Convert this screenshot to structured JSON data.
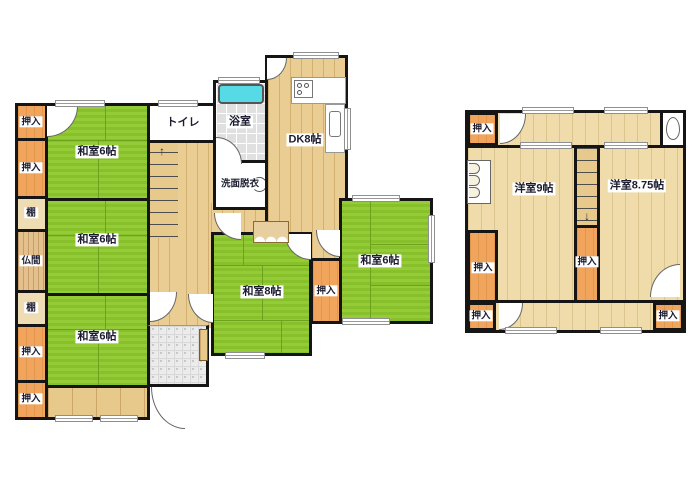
{
  "title": "2-story house floor plan",
  "colors": {
    "tatami_green": "#8fc832",
    "wood_floor_1f": "#e9cd92",
    "wood_floor_2f": "#efdcaa",
    "closet_orange": "#f0a45c",
    "bathtub_cyan": "#56dbe6",
    "wall_black": "#151515",
    "tile_gray": "#e0e0e0"
  },
  "icons": {
    "stairs_up_arrow": "↑",
    "stairs_down_arrow": "↓"
  },
  "floor1": {
    "closets_left": [
      "押入",
      "押入",
      "棚",
      "仏間",
      "棚",
      "押入",
      "押入"
    ],
    "rooms": {
      "washitsu_top": "和室6帖",
      "washitsu_mid": "和室6帖",
      "washitsu_bottom": "和室6帖",
      "toilet": "トイレ",
      "bath": "浴室",
      "washroom": "洗面脱衣",
      "dk": "DK8帖",
      "washitsu8": "和室8帖",
      "closet_center": "押入",
      "washitsu_right": "和室6帖"
    }
  },
  "floor2": {
    "rooms": {
      "closet_top": "押入",
      "western9": "洋室9帖",
      "western875": "洋室8.75帖",
      "closet_left": "押入",
      "closet_center": "押入",
      "closet_bottom_left": "押入",
      "closet_bottom_right": "押入"
    }
  }
}
